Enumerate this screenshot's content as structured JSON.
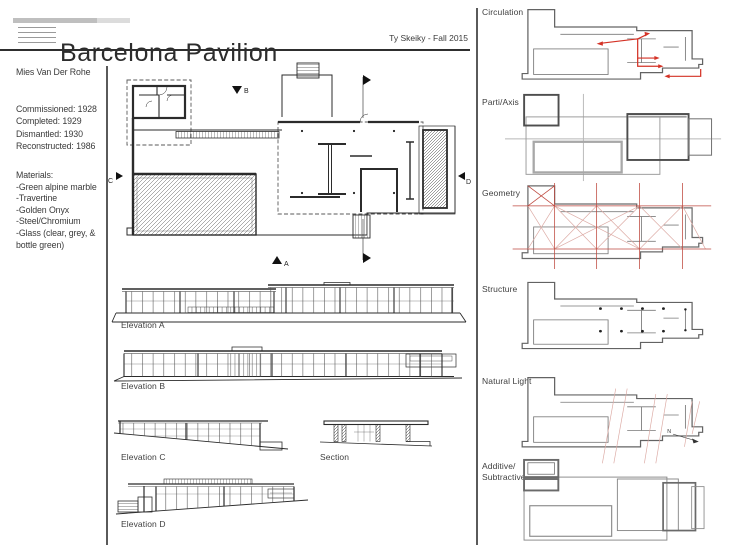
{
  "header": {
    "title": "Barcelona Pavilion",
    "credit": "Ty Skeiky - Fall 2015"
  },
  "info_panel": {
    "architect": "Mies Van Der Rohe",
    "dates": [
      "Commissioned: 1928",
      "Completed: 1929",
      "Dismantled: 1930",
      "Reconstructed: 1986"
    ],
    "materials_heading": "Materials:",
    "materials": [
      "-Green alpine marble",
      "-Travertine",
      "-Golden Onyx",
      "-Steel/Chromium",
      "-Glass (clear, grey, & bottle green)"
    ]
  },
  "plan": {
    "section_markers": {
      "a": "A",
      "b": "B",
      "c": "C",
      "d": "D"
    }
  },
  "drawings": {
    "elevation_a": "Elevation A",
    "elevation_b": "Elevation B",
    "elevation_c": "Elevation C",
    "section": "Section",
    "elevation_d": "Elevation D"
  },
  "analysis": {
    "north_label": "N",
    "items": [
      {
        "label": "Circulation"
      },
      {
        "label": "Parti/Axis"
      },
      {
        "label": "Geometry"
      },
      {
        "label": "Structure"
      },
      {
        "label": "Natural Light"
      },
      {
        "label": "Additive/ Subtractive"
      }
    ]
  },
  "colors": {
    "accent_red": "#d43226",
    "soft_red": "#dcaaa4",
    "geometry_red": "#bf4a40",
    "ink": "#2b2b2b"
  }
}
